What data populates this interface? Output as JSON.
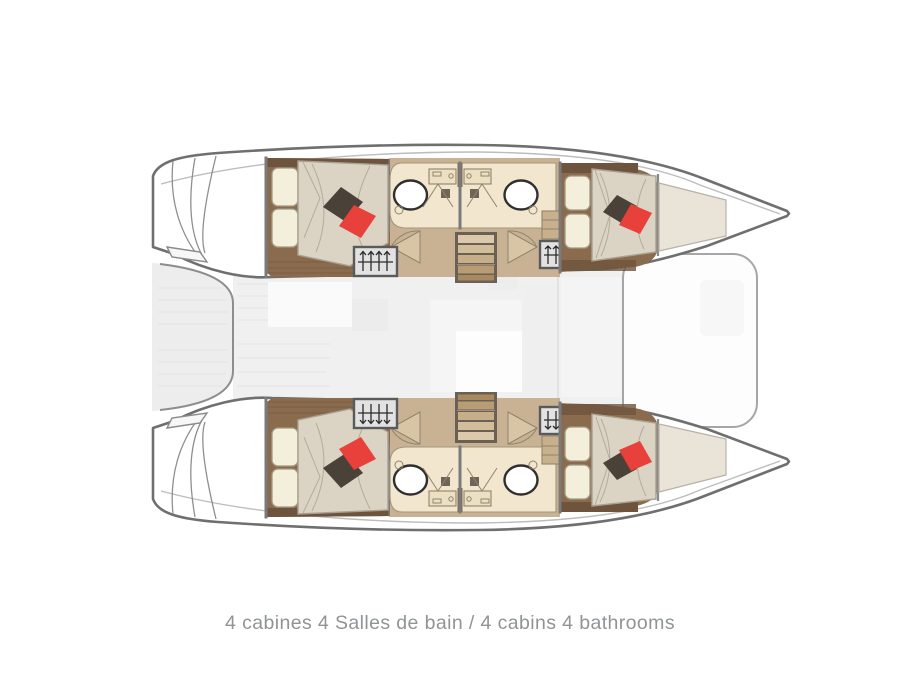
{
  "caption": {
    "text": "4 cabines 4 Salles de bain / 4 cabins 4 bathrooms"
  },
  "plan": {
    "cabins": 4,
    "bathrooms": 4,
    "staircases": 2,
    "wardrobes": 4,
    "double_beds": 4
  },
  "colors": {
    "background": "#ffffff",
    "hull_outline": "#6f6f6f",
    "inner_deck_line": "#bdbdbd",
    "wall": "#7a7a7a",
    "wood_dark": "#6e543d",
    "wood_mid": "#8a6b4e",
    "floor_tan": "#c9b294",
    "bath_cream": "#f2e7ce",
    "counter_cream": "#ecdfc2",
    "mattress": "#dbd4c5",
    "mattress_light": "#e9e4d7",
    "pillow_cream": "#f4efdb",
    "pillow_dark": "#4a4138",
    "pillow_red": "#e8403a",
    "stairs_tan": "#cdb79b",
    "wardrobe_grey": "#e2e2e2",
    "deck_grey": "#f0f0f0",
    "caption_grey": "#909497"
  }
}
